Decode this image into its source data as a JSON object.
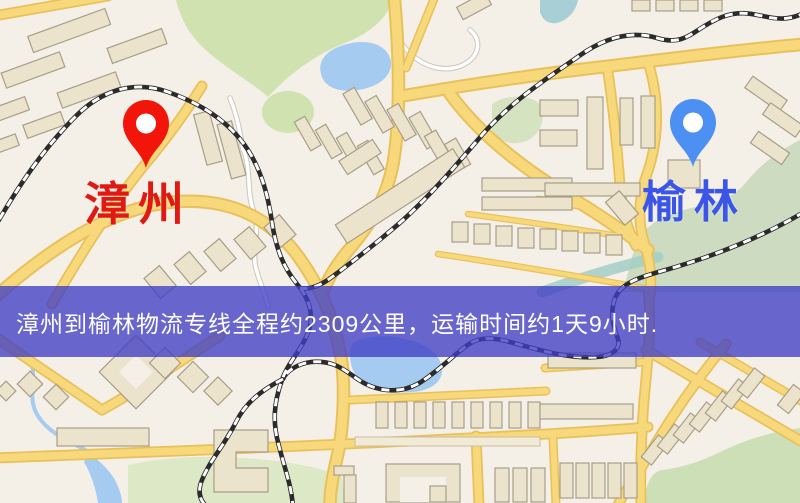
{
  "banner": {
    "text": "漳州到榆林物流专线全程约2309公里，运输时间约1天9小时.",
    "background": "rgba(64,62,196,0.78)",
    "text_color": "#ffffff"
  },
  "route": {
    "origin": "漳州",
    "destination": "榆林",
    "distance_text": "约2309公里",
    "duration_text": "约1天9小时"
  },
  "markers": {
    "origin": {
      "label": "漳州",
      "icon": "red-location-pin-icon",
      "pin_color": "#f2150a",
      "label_color": "#e01a12"
    },
    "destination": {
      "label": "榆林",
      "icon": "blue-location-pin-icon",
      "pin_color": "#4b90f2",
      "label_color": "#3a55e8"
    }
  },
  "map": {
    "colors": {
      "background": "#f4efe7",
      "road_fill": "#f7d97c",
      "road_casing": "#e9c05a",
      "minor_road": "#ffffff",
      "railway": "#2b2b2b",
      "building": "#ece3cc",
      "building_outline": "#a89e88",
      "park": "#cfe2b0",
      "water": "#a5cbf0"
    }
  }
}
